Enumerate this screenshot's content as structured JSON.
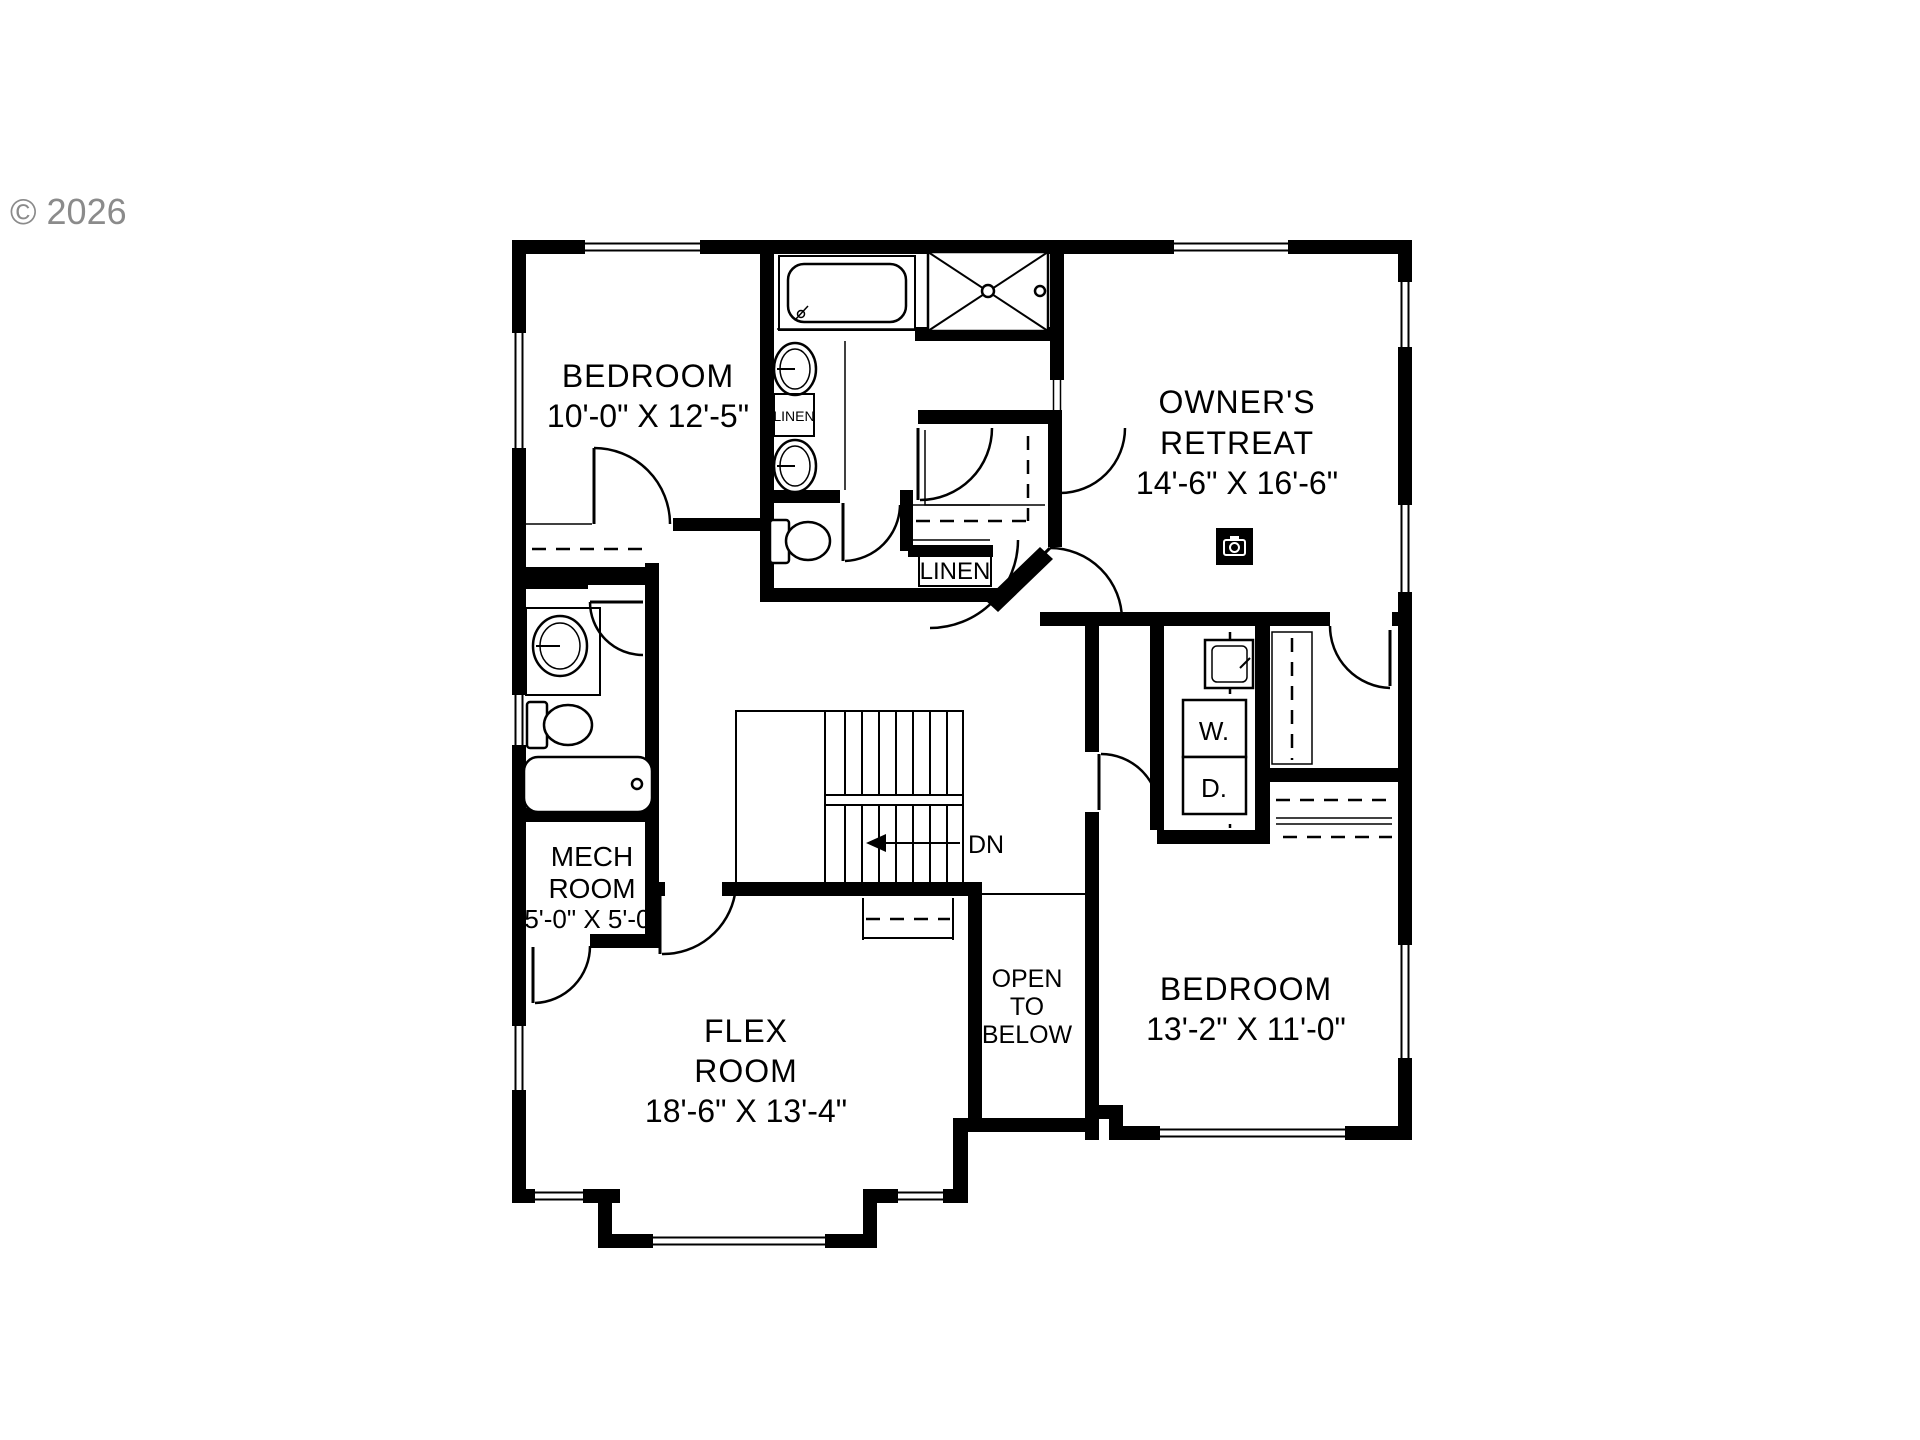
{
  "copyright": "© 2026",
  "colors": {
    "wall": "#000000",
    "background": "#ffffff",
    "copyright_gray": "#8b8b8b"
  },
  "rooms": {
    "bedroom_upper_left": {
      "name": "BEDROOM",
      "dims": "10'-0\" X 12'-5\""
    },
    "owners_retreat": {
      "line1": "OWNER'S",
      "line2": "RETREAT",
      "dims": "14'-6\" X 16'-6\""
    },
    "mech_room": {
      "line1": "MECH",
      "line2": "ROOM",
      "dims": "5'-0\" X 5'-0\""
    },
    "flex_room": {
      "line1": "FLEX",
      "line2": "ROOM",
      "dims": "18'-6\" X 13'-4\""
    },
    "bedroom_lower_right": {
      "name": "BEDROOM",
      "dims": "13'-2\" X 11'-0\""
    },
    "open_to_below": {
      "line1": "OPEN",
      "line2": "TO",
      "line3": "BELOW"
    }
  },
  "labels": {
    "linen_bath": "LINEN",
    "linen_hall": "LINEN",
    "washer": "W.",
    "dryer": "D.",
    "stair_direction": "DN"
  },
  "icons": {
    "camera_360": "camera-icon"
  }
}
